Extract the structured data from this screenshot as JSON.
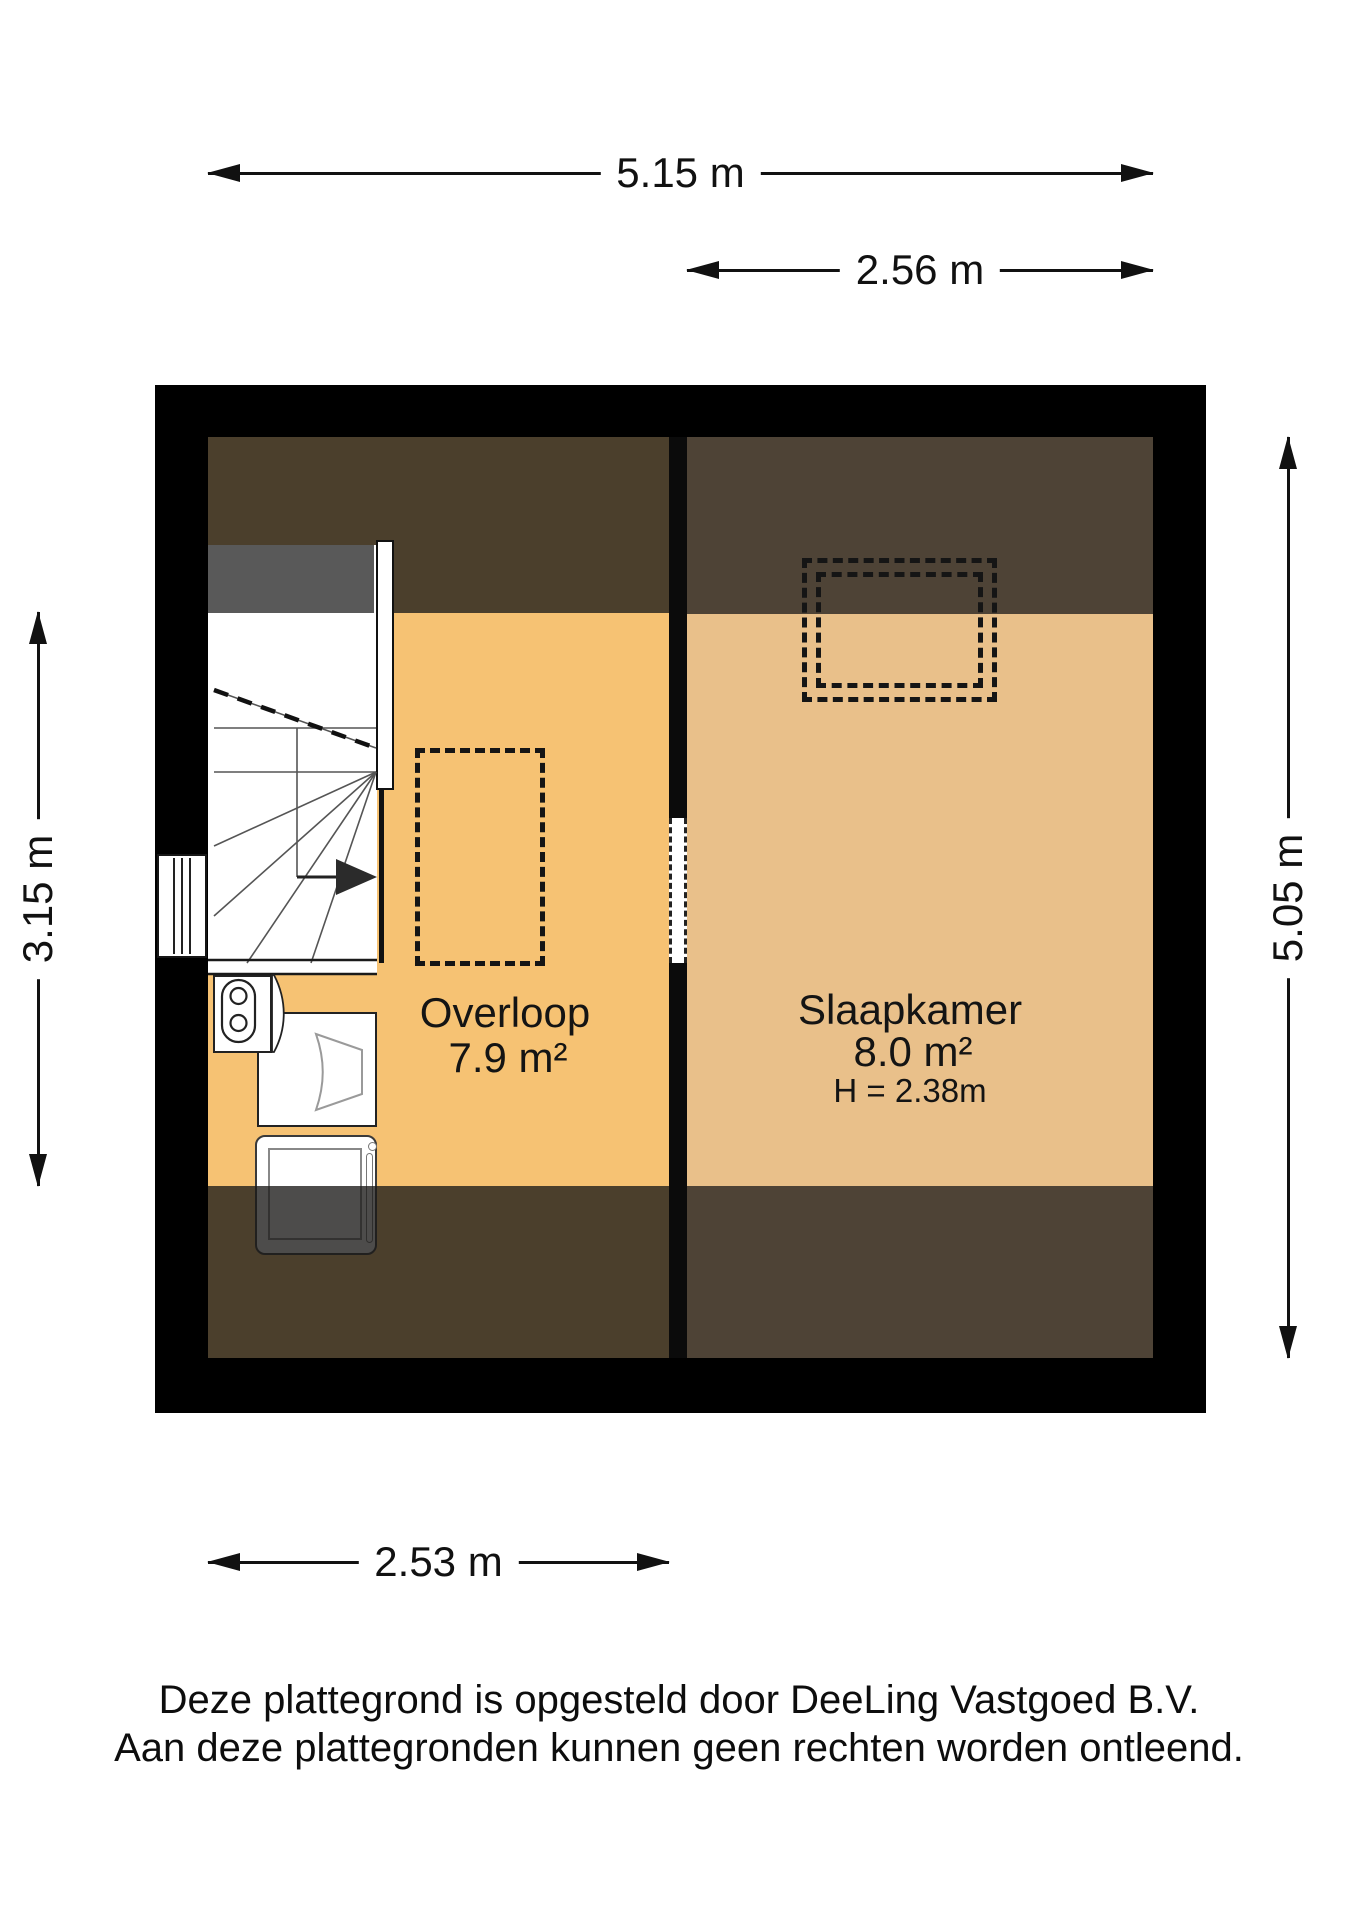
{
  "dimensions": {
    "width_total": "5.15 m",
    "width_bedroom": "2.56 m",
    "height_left": "3.15 m",
    "height_right": "5.05 m",
    "width_overloop": "2.53 m"
  },
  "rooms": {
    "overloop": {
      "name": "Overloop",
      "area": "7.9 m²"
    },
    "slaapkamer": {
      "name": "Slaapkamer",
      "area": "8.0 m²",
      "ceiling_height": "H = 2.38m"
    }
  },
  "footer": {
    "line1": "Deze plattegrond is opgesteld door DeeLing Vastgoed B.V.",
    "line2": "Aan deze plattegronden kunnen geen rechten worden ontleend."
  },
  "colors": {
    "page_bg": "#ffffff",
    "wall": "#000000",
    "floor_overloop": "#f6c273",
    "floor_slaapkamer": "#e9c08a",
    "ceiling_overloop": "#4b3f2c",
    "ceiling_slaapkamer": "#4e4336",
    "stair_headroom": "#595959"
  }
}
